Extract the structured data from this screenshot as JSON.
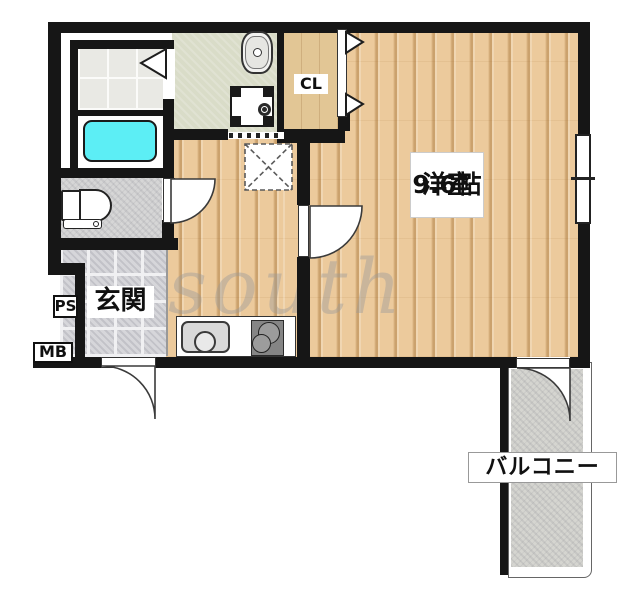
{
  "floorplan": {
    "watermark_text": "south",
    "labels": {
      "western_room_name": "洋室",
      "western_room_size": "9.6帖",
      "entrance": "玄関",
      "closet": "CL",
      "balcony": "バルコニー",
      "pipe_shaft": "PS",
      "meter_box": "MB"
    },
    "colors": {
      "wall": "#161616",
      "wood_floor": "#ecca9c",
      "closet_floor": "#e2c695",
      "washroom_floor": "#d9dcc8",
      "bath_tile": "#e9e9e4",
      "bathtub": "#5ceef5",
      "entrance_tile": "#d6d6da",
      "toilet_floor": "#d6d6d6",
      "balcony_floor": "#d5d5d0",
      "kitchen_stove": "#858585"
    }
  }
}
